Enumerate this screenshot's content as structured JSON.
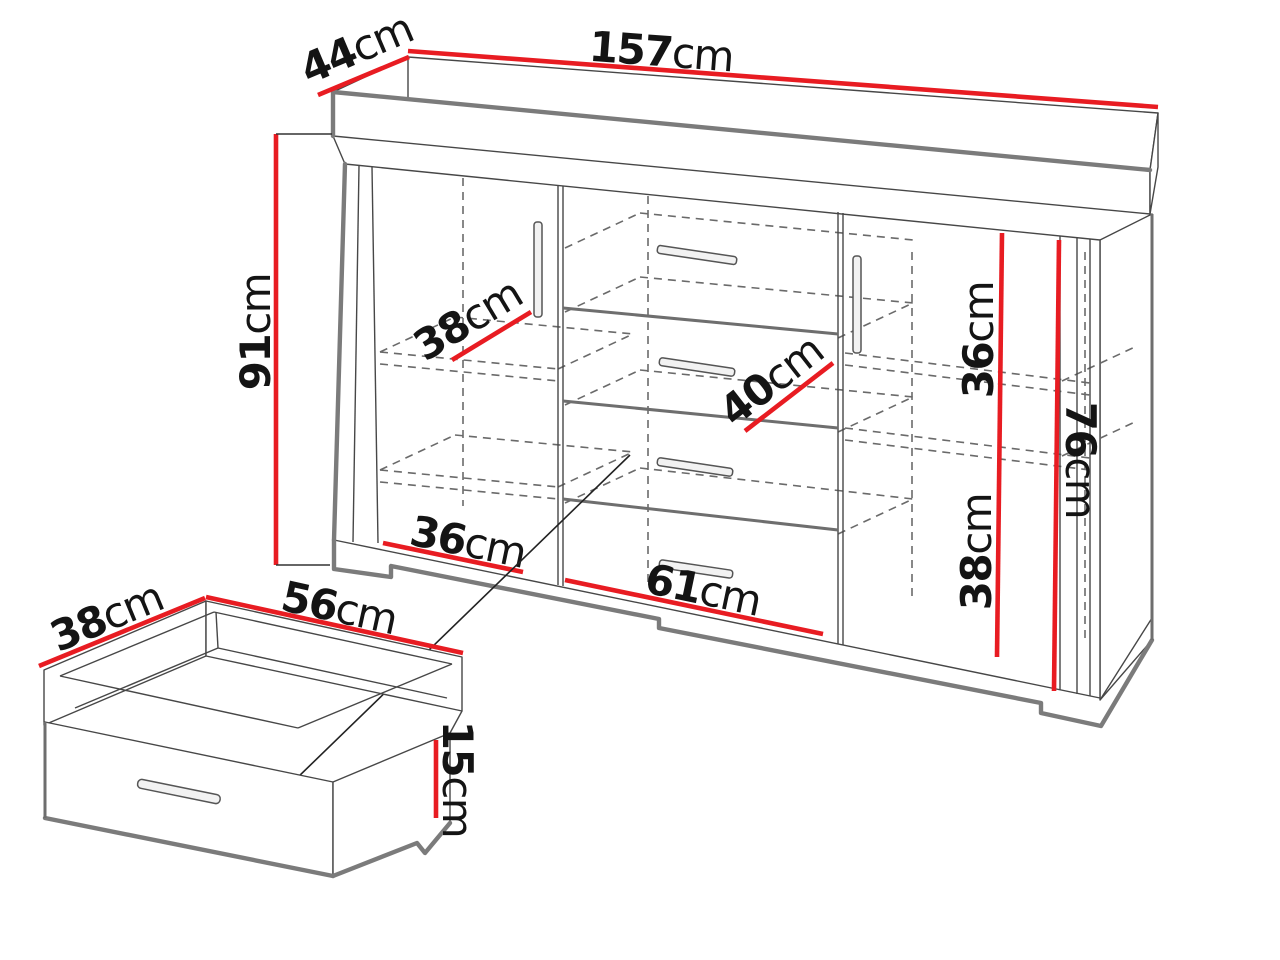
{
  "figure": {
    "type": "furniture-dimension-diagram",
    "subject": "sideboard cabinet with two doors, four drawers and a detail view of one internal drawer",
    "unit": "cm"
  },
  "cabinet": {
    "width": {
      "num": "157",
      "unit": "cm"
    },
    "depth": {
      "num": "44",
      "unit": "cm"
    },
    "height": {
      "num": "91",
      "unit": "cm"
    },
    "shelf_depth": {
      "num": "38",
      "unit": "cm"
    },
    "drawer_diagonal": {
      "num": "40",
      "unit": "cm"
    },
    "right_upper_height": {
      "num": "36",
      "unit": "cm"
    },
    "right_lower_height": {
      "num": "38",
      "unit": "cm"
    },
    "interior_height": {
      "num": "76",
      "unit": "cm"
    },
    "left_section_width": {
      "num": "36",
      "unit": "cm"
    },
    "middle_section_width": {
      "num": "61",
      "unit": "cm"
    }
  },
  "drawer": {
    "depth": {
      "num": "38",
      "unit": "cm"
    },
    "width": {
      "num": "56",
      "unit": "cm"
    },
    "height": {
      "num": "15",
      "unit": "cm"
    }
  },
  "colors": {
    "dimension_red": "#e81c22",
    "outline_thin": "#474747",
    "outline_thick": "#7b7b7b",
    "dashed": "#6a6a6a",
    "text": "#141414",
    "background": "#ffffff"
  }
}
